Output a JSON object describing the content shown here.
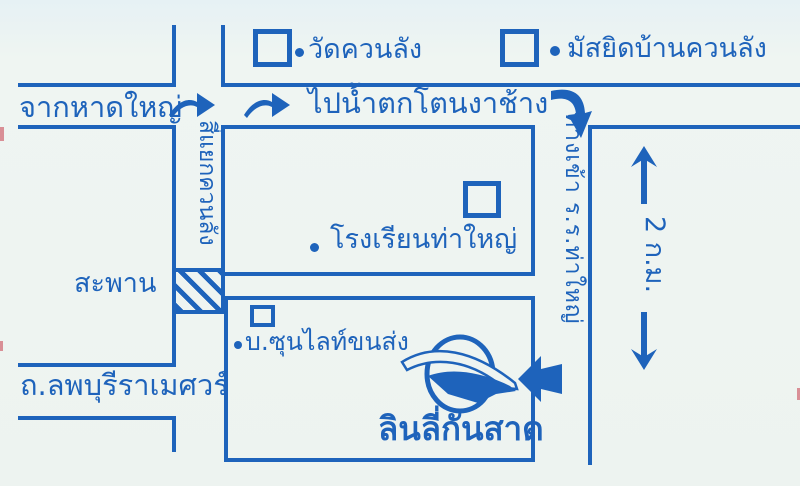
{
  "colors": {
    "ink": "#1e63bb",
    "paper": "#eef4f1"
  },
  "landmarks": {
    "temple": {
      "label": "วัดควนลัง"
    },
    "mosque": {
      "label": "มัสยิดบ้านควนลัง"
    },
    "school": {
      "label": "โรงเรียนท่าใหญ่"
    },
    "transport": {
      "label": "บ.ซุนไลท์ขนส่ง"
    },
    "company": {
      "label": "ลินลี่กันสาด"
    }
  },
  "roads": {
    "from_hatyai": "จากหาดใหญ่",
    "to_waterfall": "ไปน้ำตกโตนงาช้าง",
    "junction": "สี่แยกควนลัง",
    "bridge": "สะพาน",
    "lopburi_road": "ถ.ลพบุรีราเมศวร์",
    "school_entrance": "ทางเข้า ร.ร.ท่าใหญ่",
    "distance": "2 ก.ม."
  }
}
